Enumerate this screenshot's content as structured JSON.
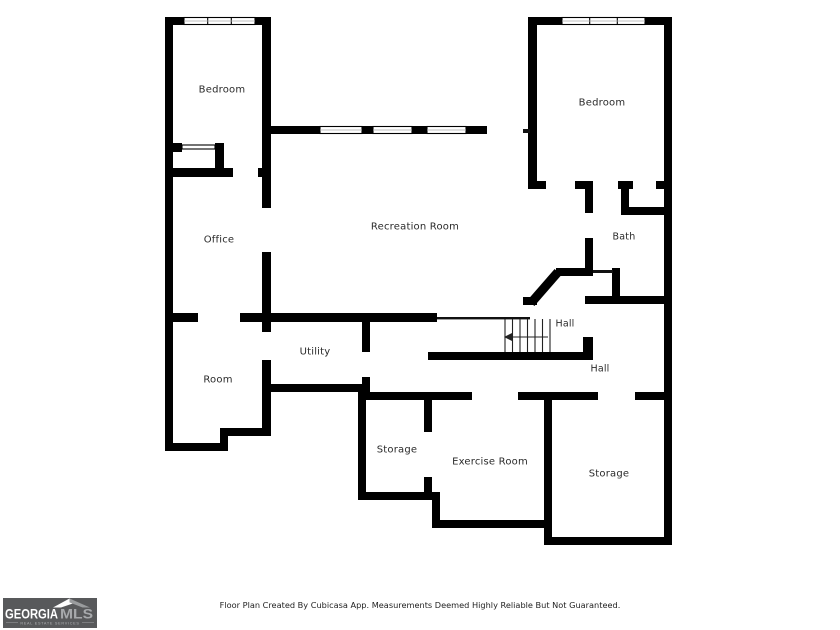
{
  "plan": {
    "rooms": {
      "bedroom_left": "Bedroom",
      "bedroom_right": "Bedroom",
      "office": "Office",
      "recreation_room": "Recreation Room",
      "bath": "Bath",
      "hall_upper": "Hall",
      "hall_lower": "Hall",
      "utility": "Utility",
      "room": "Room",
      "storage_center": "Storage",
      "exercise_room": "Exercise Room",
      "storage_right": "Storage"
    }
  },
  "footer": {
    "disclaimer": "Floor Plan Created By Cubicasa App. Measurements Deemed Highly Reliable But Not Guaranteed."
  },
  "logo": {
    "brand_primary": "GEORGIA",
    "brand_secondary": "MLS",
    "tagline": "REAL ESTATE SERVICES"
  },
  "colors": {
    "wall": "#000000",
    "label_text": "#2a2a2a",
    "logo_background": "#58595b",
    "logo_primary_text": "#ffffff",
    "logo_secondary_text": "#a7a9ac",
    "logo_tagline_text": "#b0b2b5"
  }
}
